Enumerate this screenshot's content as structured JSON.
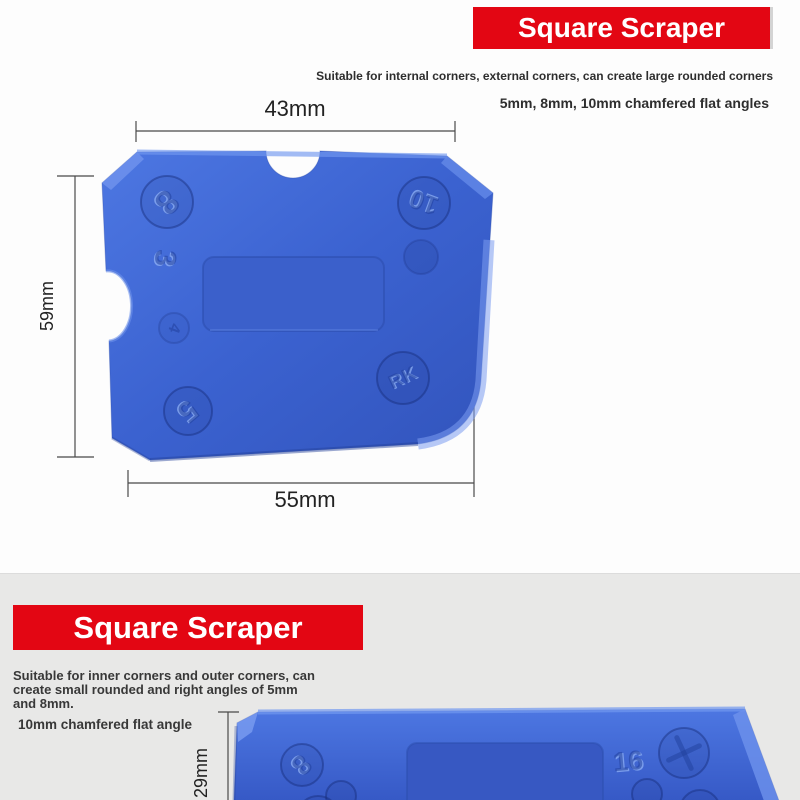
{
  "top_section": {
    "banner_title": "Square Scraper",
    "subtitle_line1": "Suitable for internal corners, external corners, can create large rounded corners",
    "subtitle_line2": "5mm, 8mm, 10mm chamfered flat angles",
    "dim_top_width": "43mm",
    "dim_left_height": "59mm",
    "dim_bottom_width": "55mm",
    "markings": {
      "m8": "8",
      "m10": "10",
      "m3": "3",
      "m4": "4",
      "m5": "5",
      "logo": "RK"
    }
  },
  "bottom_section": {
    "banner_title": "Square Scraper",
    "description_lines": [
      "Suitable for inner corners and outer corners, can",
      "create small rounded and right angles of 5mm",
      "and 8mm."
    ],
    "feature_label": "10mm chamfered flat angle",
    "dim_left_height": "29mm",
    "markings": {
      "m8": "8",
      "m16": "16"
    }
  },
  "colors": {
    "banner_red": "#e30613",
    "banner_text": "#ffffff",
    "scraper_blue": "#3d64d1",
    "scraper_blue_light": "#7298f0",
    "scraper_blue_dark": "#2c4dad",
    "background_top": "#fdfdfd",
    "background_bottom": "#e8e8e7",
    "dimension_line": "#4a4a4a"
  }
}
